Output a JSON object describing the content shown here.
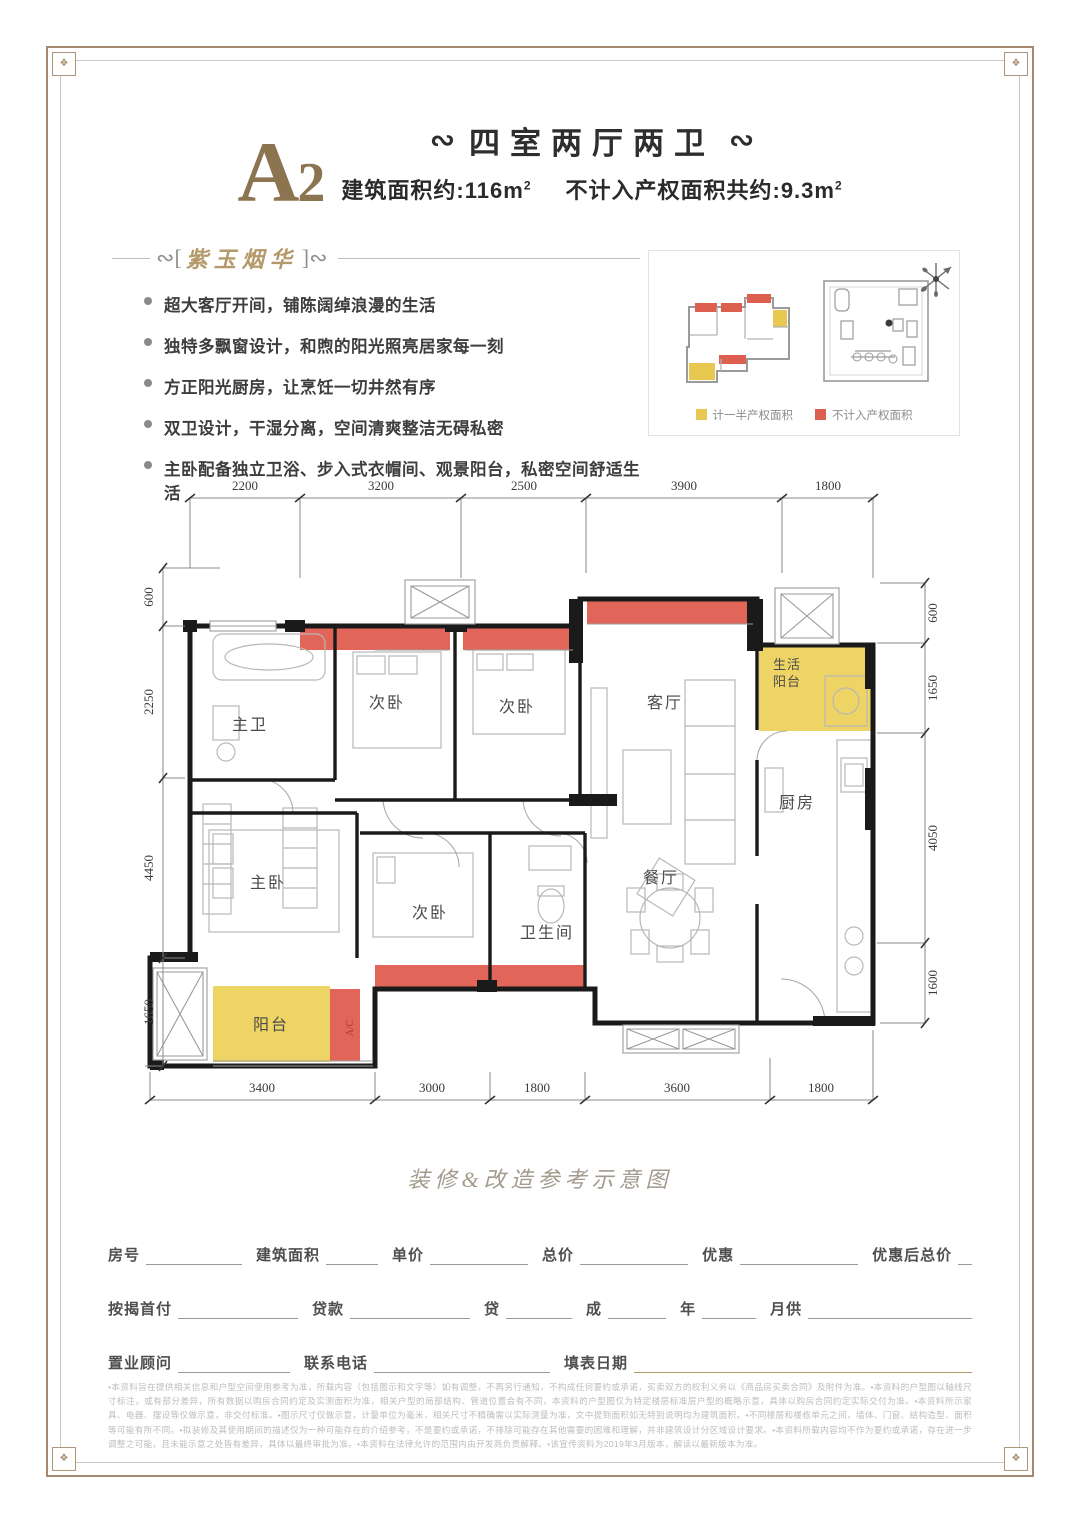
{
  "header": {
    "plan_code_letter": "A",
    "plan_code_number": "2",
    "ornament_left": "∾",
    "ornament_right": "∾",
    "title": "四室两厅两卫",
    "area1_label": "建筑面积约:116m",
    "area1_sup": "2",
    "area2_label": "不计入产权面积共约:9.3m",
    "area2_sup": "2"
  },
  "features": {
    "bracket_open": "[",
    "bracket_close": "]",
    "tagline": "紫玉烟华",
    "swirl": "∾",
    "bullets": [
      "超大客厅开间，铺陈阔绰浪漫的生活",
      "独特多飘窗设计，和煦的阳光照亮居家每一刻",
      "方正阳光厨房，让烹饪一切井然有序",
      "双卫设计，干湿分离，空间清爽整洁无碍私密",
      "主卧配备独立卫浴、步入式衣帽间、观景阳台，私密空间舒适生活"
    ]
  },
  "panel": {
    "legend": [
      {
        "label": "计一半产权面积",
        "color": "#e9c852"
      },
      {
        "label": "不计入产权面积",
        "color": "#dd5f50"
      }
    ]
  },
  "plan": {
    "colors": {
      "half_area": "#eed464",
      "excluded_area": "#e2655a",
      "wall": "#1a1a1a"
    },
    "dims_top": [
      "2200",
      "3200",
      "2500",
      "3900",
      "1800"
    ],
    "dims_left": [
      "600",
      "2250",
      "4450",
      "1650"
    ],
    "dims_right": [
      "600",
      "1650",
      "4050",
      "1600"
    ],
    "dims_bottom": [
      "3400",
      "3000",
      "1800",
      "3600",
      "1800"
    ],
    "rooms": {
      "master_bath": "主卫",
      "bedroom_a": "次卧",
      "bedroom_b": "次卧",
      "living": "客厅",
      "life_balcony_1": "生活",
      "life_balcony_2": "阳台",
      "kitchen": "厨房",
      "master_bedroom": "主卧",
      "bedroom_c": "次卧",
      "bathroom": "卫生间",
      "dining": "餐厅",
      "balcony": "阳台",
      "ac": "A/C"
    }
  },
  "caption": "装修&改造参考示意图",
  "form": {
    "row1": [
      "房号",
      "建筑面积",
      "单价",
      "总价",
      "优惠",
      "优惠后总价"
    ],
    "row2": [
      "按揭首付",
      "贷款",
      "贷",
      "成",
      "年",
      "月供"
    ],
    "row3": [
      "置业顾问",
      "联系电话",
      "填表日期"
    ]
  },
  "disclaimer": "•本资料旨在提供相关信息和户型空间使用参考为准，所载内容（包括图示和文字等）如有调整，不再另行通知，不构成任何要约或承诺，买卖双方的权利义务以《商品房买卖合同》及附件为准。•本资料的户型图以轴线尺寸标注，或有部分差异，所有数据以购房合同约定及实测面积为准，相关户型的局部结构、管道位置会有不同，本资料的户型图仅为特定楼层标准层户型的概略示意，具体以购房合同约定实际交付为准。•本资料所示家具、电器、摆设等仅做示意，非交付标准。•图示尺寸仅做示意，计量单位为毫米，相关尺寸不精确需以实际测量为准，文中提到面积如无特别说明均为建筑面积。•不同楼层和楼栋单元之间，墙体、门窗、结构造型、面积等可能有所不同。•拟装修及其使用期间的描述仅为一种可能存在的介绍参考，不是要约或承诺，不排除可能存在其他需要的困难和理解，并非建筑设计分区域设计要求。•本资料所载内容均不作为要约或承诺，存在进一步调整之可能，且未能示意之处皆有差异，具体以最终审批为准。•本资料在法律允许的范围内由开发商负责解释。•该宣传资料为2019年3月版本，解读以最新版本为准。",
  "corner_glyph": "❖"
}
